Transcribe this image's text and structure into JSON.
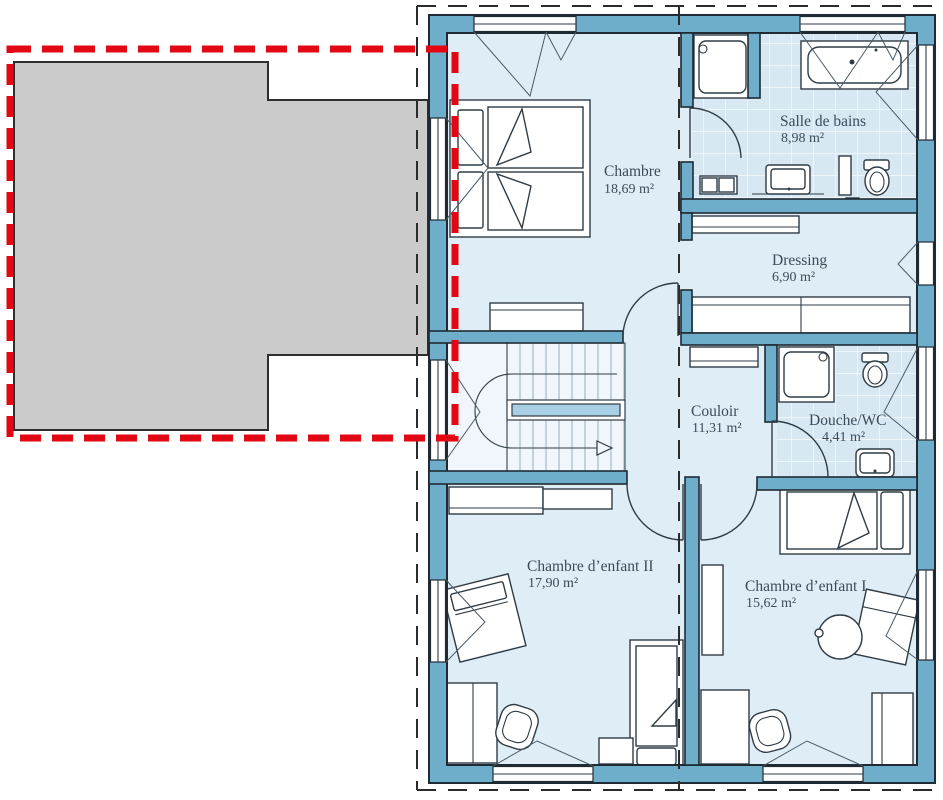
{
  "plan": {
    "rooms": {
      "chambre": {
        "name": "Chambre",
        "area": "18,69 m²"
      },
      "salle_de_bains": {
        "name": "Salle de bains",
        "area": "8,98 m²"
      },
      "dressing": {
        "name": "Dressing",
        "area": "6,90 m²"
      },
      "couloir": {
        "name": "Couloir",
        "area": "11,31 m²"
      },
      "douche_wc": {
        "name": "Douche/WC",
        "area": "4,41 m²"
      },
      "chambre_enfant_2": {
        "name": "Chambre d’enfant II",
        "area": "17,90 m²"
      },
      "chambre_enfant_1": {
        "name": "Chambre d’enfant I",
        "area": "15,62 m²"
      }
    },
    "colors": {
      "wall": "#6FAECB",
      "floor": "#DFEDF7",
      "tile_floor": "#D7E8F3",
      "stair_floor": "#F0F6FB",
      "stair_rail": "#A9CFE4",
      "roof_overlay": "#CBCBCB",
      "highlight": "#E30613",
      "line": "#2F3B45",
      "label_text": "#3D4B59"
    }
  }
}
